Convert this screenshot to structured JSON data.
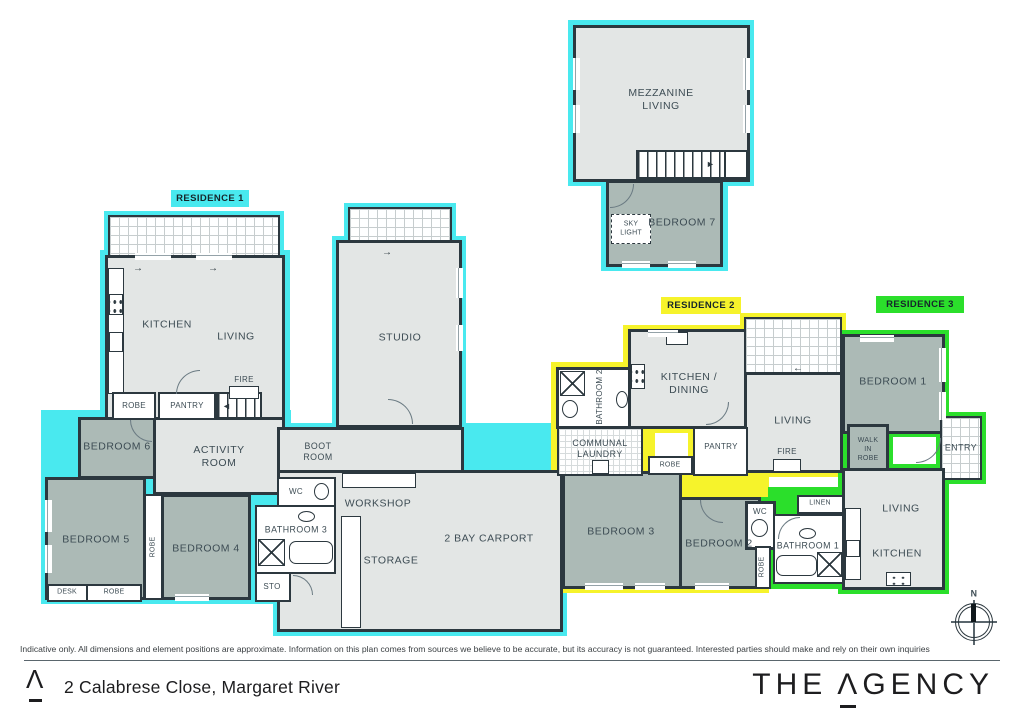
{
  "meta": {
    "address": "2 Calabrese Close, Margaret River",
    "disclaimer": "Indicative only. All dimensions and element positions are approximate. Information on this plan comes from sources we believe to be accurate, but its accuracy is not guaranteed. Interested parties should make and rely on their own inquiries",
    "north_label": "N"
  },
  "brand": {
    "prefix": "THE",
    "a_glyph": "Λ",
    "suffix": "GENCY",
    "logo_glyph": "Λ"
  },
  "palette": {
    "wall": "#2C383F",
    "room_light": "#E3E6E5",
    "room_sage": "#ACBAB6",
    "residence1_cyan": "#49E9EF",
    "residence2_yellow": "#F6F32B",
    "residence3_green": "#2BDF2B"
  },
  "residences": [
    {
      "label": "RESIDENCE 1",
      "color": "#49E9EF"
    },
    {
      "label": "RESIDENCE 2",
      "color": "#F6F32B"
    },
    {
      "label": "RESIDENCE 3",
      "color": "#2BDF2B"
    }
  ],
  "rooms": {
    "mezzanine_living": "MEZZANINE\nLIVING",
    "bedroom7": "BEDROOM 7",
    "skylight": "SKY\nLIGHT",
    "kitchen1": "KITCHEN",
    "living1": "LIVING",
    "fire1": "FIRE",
    "robe_kitchen": "ROBE",
    "pantry1": "PANTRY",
    "bedroom6": "BEDROOM 6",
    "activity_room": "ACTIVITY\nROOM",
    "bedroom5": "BEDROOM 5",
    "desk5": "DESK",
    "robe5": "ROBE",
    "robe45": "ROBE",
    "bedroom4": "BEDROOM 4",
    "wc1": "WC",
    "bathroom3": "BATHROOM 3",
    "sto": "STO",
    "boot_room": "BOOT\nROOM",
    "workshop": "WORKSHOP",
    "storage": "STORAGE",
    "carport": "2 BAY CARPORT",
    "studio": "STUDIO",
    "bathroom2": "BATHROOM 2",
    "kitchen_dining2": "KITCHEN /\nDINING",
    "communal_laundry": "COMMUNAL\nLAUNDRY",
    "pantry2": "PANTRY",
    "robe2": "ROBE",
    "living2": "LIVING",
    "fire2": "FIRE",
    "bedroom3": "BEDROOM 3",
    "bedroom2": "BEDROOM 2",
    "wc3": "WC",
    "robe_bed2": "ROBE",
    "bedroom1": "BEDROOM 1",
    "walk_in_robe": "WALK\nIN\nROBE",
    "entry": "ENTRY",
    "linen": "LINEN",
    "bathroom1": "BATHROOM 1",
    "living3": "LIVING",
    "kitchen3": "KITCHEN"
  }
}
